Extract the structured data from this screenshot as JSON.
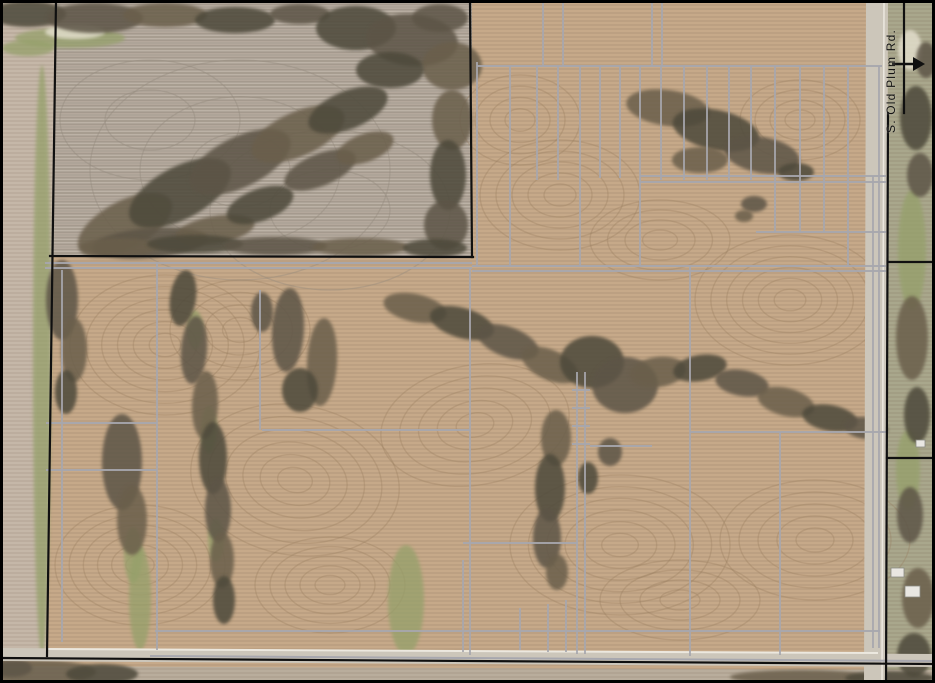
{
  "map": {
    "road_label": "S. Old Plum Rd.",
    "palette": {
      "field": "#c6a989",
      "fallow": "#bcb2a6",
      "left_strip": "#c5b7a8",
      "verge": "#a9a78c",
      "bottom_strip": "#b9ad9c",
      "road": "#ccc6ba",
      "road_edge": "#ece8df",
      "tile": "#a7a7ae",
      "boundary": "#101010",
      "contour": "#977c5e",
      "fallow_line": "#938a7c",
      "grass": "#95a06b",
      "light": "#e6e1d0",
      "tree_colors": [
        "#4d493a",
        "#5d5546",
        "#6a5e4b"
      ]
    },
    "fields": [
      {
        "points": "0,0 935,0 935,683 0,683",
        "fill": "field",
        "stripe": "stripeMain"
      },
      {
        "points": "0,0 56,0 46,660 0,660",
        "fill": "left_strip"
      },
      {
        "points": "56,0 472,0 472,257 51,256",
        "fill": "fallow",
        "stripe": "stripeFallow"
      },
      {
        "points": "888,0 935,0 935,683 886,683",
        "fill": "verge"
      },
      {
        "points": "0,666 935,670 935,683 0,683",
        "fill": "bottom_strip"
      }
    ],
    "texture": {
      "swirls": [
        [
          165,
          345,
          95,
          70,
          6,
          0
        ],
        [
          140,
          565,
          85,
          60,
          6,
          0
        ],
        [
          295,
          480,
          105,
          75,
          6,
          10
        ],
        [
          330,
          585,
          75,
          48,
          5,
          0
        ],
        [
          475,
          425,
          95,
          60,
          5,
          -10
        ],
        [
          620,
          545,
          110,
          70,
          6,
          0
        ],
        [
          790,
          300,
          95,
          65,
          6,
          0
        ],
        [
          815,
          540,
          95,
          60,
          5,
          0
        ],
        [
          560,
          195,
          80,
          55,
          5,
          0
        ],
        [
          660,
          240,
          70,
          40,
          4,
          0
        ],
        [
          800,
          120,
          60,
          40,
          4,
          0
        ],
        [
          520,
          120,
          60,
          45,
          4,
          0
        ],
        [
          240,
          330,
          70,
          50,
          4,
          0
        ],
        [
          680,
          600,
          80,
          40,
          4,
          0
        ]
      ],
      "fallow_swirls": [
        [
          240,
          170,
          150,
          110,
          3,
          0
        ],
        [
          150,
          120,
          90,
          60,
          2,
          0
        ],
        [
          330,
          210,
          120,
          80,
          2,
          0
        ]
      ]
    },
    "grass": [
      [
        70,
        38,
        55,
        10
      ],
      [
        28,
        48,
        26,
        8
      ],
      [
        42,
        360,
        9,
        295
      ],
      [
        140,
        598,
        11,
        52
      ],
      [
        406,
        600,
        18,
        55
      ],
      [
        133,
        555,
        9,
        28
      ],
      [
        195,
        330,
        8,
        20
      ],
      [
        209,
        430,
        8,
        24
      ],
      [
        216,
        540,
        8,
        22
      ],
      [
        912,
        250,
        14,
        60
      ],
      [
        908,
        470,
        12,
        40
      ]
    ],
    "light_patches": [
      [
        75,
        32,
        30,
        7
      ],
      [
        910,
        50,
        12,
        20
      ]
    ],
    "trees": [
      [
        28,
        14,
        38,
        13,
        0
      ],
      [
        95,
        18,
        48,
        15,
        0
      ],
      [
        165,
        15,
        42,
        12,
        0
      ],
      [
        235,
        20,
        40,
        13,
        0
      ],
      [
        300,
        14,
        30,
        10,
        0
      ],
      [
        125,
        225,
        52,
        24,
        -28
      ],
      [
        180,
        193,
        56,
        26,
        -28
      ],
      [
        240,
        162,
        55,
        25,
        -26
      ],
      [
        298,
        134,
        50,
        22,
        -24
      ],
      [
        348,
        110,
        42,
        19,
        -22
      ],
      [
        150,
        243,
        58,
        15,
        -5
      ],
      [
        215,
        230,
        40,
        14,
        -10
      ],
      [
        260,
        205,
        35,
        16,
        -20
      ],
      [
        320,
        170,
        38,
        16,
        -22
      ],
      [
        365,
        148,
        30,
        14,
        -20
      ],
      [
        356,
        28,
        40,
        22,
        0
      ],
      [
        412,
        40,
        46,
        26,
        5
      ],
      [
        452,
        66,
        30,
        24,
        0
      ],
      [
        390,
        70,
        34,
        18,
        0
      ],
      [
        440,
        18,
        28,
        14,
        0
      ],
      [
        452,
        120,
        20,
        30,
        0
      ],
      [
        448,
        175,
        18,
        35,
        0
      ],
      [
        446,
        225,
        22,
        25,
        0
      ],
      [
        120,
        247,
        40,
        9,
        0
      ],
      [
        195,
        244,
        48,
        9,
        0
      ],
      [
        275,
        246,
        52,
        9,
        0
      ],
      [
        360,
        247,
        48,
        9,
        0
      ],
      [
        435,
        248,
        32,
        9,
        0
      ],
      [
        62,
        300,
        16,
        40,
        0
      ],
      [
        74,
        350,
        13,
        32,
        0
      ],
      [
        66,
        392,
        11,
        22,
        0
      ],
      [
        122,
        462,
        20,
        48,
        0
      ],
      [
        132,
        520,
        15,
        35,
        0
      ],
      [
        183,
        298,
        13,
        28,
        8
      ],
      [
        194,
        350,
        13,
        34,
        4
      ],
      [
        205,
        405,
        13,
        34,
        2
      ],
      [
        213,
        458,
        14,
        36,
        0
      ],
      [
        218,
        510,
        13,
        32,
        0
      ],
      [
        222,
        560,
        12,
        28,
        0
      ],
      [
        224,
        600,
        11,
        24,
        0
      ],
      [
        288,
        330,
        16,
        42,
        3
      ],
      [
        322,
        362,
        15,
        44,
        3
      ],
      [
        300,
        390,
        18,
        22,
        0
      ],
      [
        262,
        312,
        11,
        20,
        0
      ],
      [
        415,
        308,
        32,
        14,
        12
      ],
      [
        462,
        323,
        33,
        15,
        16
      ],
      [
        508,
        342,
        32,
        15,
        20
      ],
      [
        550,
        365,
        30,
        15,
        24
      ],
      [
        592,
        362,
        32,
        26,
        0
      ],
      [
        625,
        385,
        33,
        28,
        0
      ],
      [
        658,
        372,
        28,
        15,
        -8
      ],
      [
        700,
        368,
        27,
        13,
        -10
      ],
      [
        742,
        383,
        27,
        13,
        10
      ],
      [
        786,
        402,
        29,
        14,
        14
      ],
      [
        830,
        418,
        28,
        13,
        10
      ],
      [
        866,
        428,
        22,
        11,
        6
      ],
      [
        556,
        438,
        15,
        28,
        0
      ],
      [
        550,
        488,
        15,
        34,
        0
      ],
      [
        547,
        538,
        14,
        30,
        0
      ],
      [
        557,
        572,
        11,
        18,
        0
      ],
      [
        588,
        478,
        10,
        16,
        0
      ],
      [
        610,
        452,
        12,
        14,
        0
      ],
      [
        668,
        108,
        42,
        18,
        8
      ],
      [
        716,
        130,
        44,
        20,
        12
      ],
      [
        762,
        155,
        38,
        18,
        10
      ],
      [
        700,
        160,
        28,
        13,
        0
      ],
      [
        796,
        172,
        18,
        9,
        0
      ],
      [
        754,
        204,
        13,
        8,
        0
      ],
      [
        744,
        216,
        9,
        6,
        0
      ],
      [
        916,
        118,
        16,
        32,
        0
      ],
      [
        920,
        175,
        13,
        22,
        0
      ],
      [
        912,
        338,
        16,
        42,
        0
      ],
      [
        917,
        415,
        13,
        28,
        0
      ],
      [
        910,
        515,
        13,
        28,
        0
      ],
      [
        918,
        598,
        16,
        30,
        0
      ],
      [
        914,
        655,
        17,
        22,
        0
      ],
      [
        926,
        60,
        10,
        18,
        0
      ],
      [
        38,
        672,
        58,
        12,
        0
      ],
      [
        102,
        674,
        36,
        10,
        0
      ],
      [
        12,
        668,
        20,
        9,
        0
      ],
      [
        800,
        677,
        70,
        7,
        0
      ],
      [
        890,
        678,
        45,
        7,
        0
      ]
    ],
    "roads": {
      "bottom": "0,648 935,654 935,667 0,661",
      "right": "866,0 888,0 886,683 864,683",
      "edge_lines": [
        {
          "x1": 46,
          "y1": 649,
          "x2": 878,
          "y2": 653,
          "color": "road_edge",
          "w": 2
        },
        {
          "x1": 884,
          "y1": 2,
          "x2": 882,
          "y2": 683,
          "color": "road_edge",
          "w": 1.5
        },
        {
          "x1": 150,
          "y1": 656,
          "x2": 933,
          "y2": 661,
          "color": "tile",
          "w": 2
        }
      ]
    },
    "buildings": [
      [
        891,
        568,
        13,
        9
      ],
      [
        905,
        586,
        15,
        11
      ],
      [
        916,
        440,
        9,
        7
      ]
    ],
    "tile_lines": [
      [
        477,
        62,
        477,
        267
      ],
      [
        477,
        66,
        882,
        66
      ],
      [
        510,
        66,
        510,
        267
      ],
      [
        537,
        66,
        537,
        180
      ],
      [
        558,
        66,
        558,
        180
      ],
      [
        580,
        66,
        580,
        267
      ],
      [
        600,
        66,
        600,
        178
      ],
      [
        620,
        66,
        620,
        178
      ],
      [
        640,
        66,
        640,
        267
      ],
      [
        661,
        66,
        661,
        180
      ],
      [
        684,
        66,
        684,
        180
      ],
      [
        707,
        66,
        707,
        180
      ],
      [
        729,
        66,
        729,
        180
      ],
      [
        751,
        66,
        751,
        180
      ],
      [
        775,
        66,
        775,
        232
      ],
      [
        800,
        66,
        800,
        232
      ],
      [
        824,
        66,
        824,
        232
      ],
      [
        848,
        66,
        848,
        267
      ],
      [
        543,
        0,
        543,
        66
      ],
      [
        563,
        0,
        563,
        66
      ],
      [
        652,
        0,
        652,
        66
      ],
      [
        662,
        0,
        662,
        66
      ],
      [
        640,
        176,
        886,
        176
      ],
      [
        640,
        182,
        886,
        182
      ],
      [
        756,
        232,
        886,
        232
      ],
      [
        472,
        266,
        886,
        266
      ],
      [
        472,
        271,
        886,
        271
      ],
      [
        879,
        66,
        879,
        648
      ],
      [
        873,
        176,
        873,
        648
      ],
      [
        62,
        270,
        62,
        642
      ],
      [
        157,
        262,
        157,
        650
      ],
      [
        260,
        290,
        260,
        430
      ],
      [
        45,
        263,
        472,
        263
      ],
      [
        45,
        268,
        472,
        268
      ],
      [
        46,
        423,
        157,
        423
      ],
      [
        46,
        470,
        157,
        470
      ],
      [
        262,
        430,
        470,
        430
      ],
      [
        470,
        268,
        470,
        655
      ],
      [
        463,
        560,
        463,
        652
      ],
      [
        577,
        372,
        577,
        654
      ],
      [
        585,
        372,
        585,
        654
      ],
      [
        572,
        390,
        590,
        390
      ],
      [
        572,
        408,
        590,
        408
      ],
      [
        572,
        426,
        590,
        426
      ],
      [
        572,
        444,
        590,
        444
      ],
      [
        566,
        600,
        566,
        652
      ],
      [
        548,
        604,
        548,
        652
      ],
      [
        520,
        608,
        520,
        650
      ],
      [
        690,
        267,
        690,
        656
      ],
      [
        690,
        432,
        886,
        432
      ],
      [
        780,
        432,
        780,
        655
      ],
      [
        463,
        543,
        578,
        543
      ],
      [
        590,
        446,
        652,
        446
      ],
      [
        155,
        631,
        880,
        631
      ]
    ],
    "boundaries": [
      [
        56,
        0,
        47,
        656
      ],
      [
        50,
        256,
        473,
        257
      ],
      [
        472,
        257,
        470,
        0
      ],
      [
        904,
        0,
        904,
        113
      ],
      [
        888,
        113,
        886,
        683
      ],
      [
        0,
        658,
        935,
        664
      ],
      [
        888,
        262,
        935,
        262
      ],
      [
        887,
        458,
        935,
        458
      ]
    ],
    "arrow": {
      "x1": 892,
      "y1": 64,
      "x2": 913,
      "y2": 64,
      "head": "913,57 925,64 913,71"
    }
  }
}
